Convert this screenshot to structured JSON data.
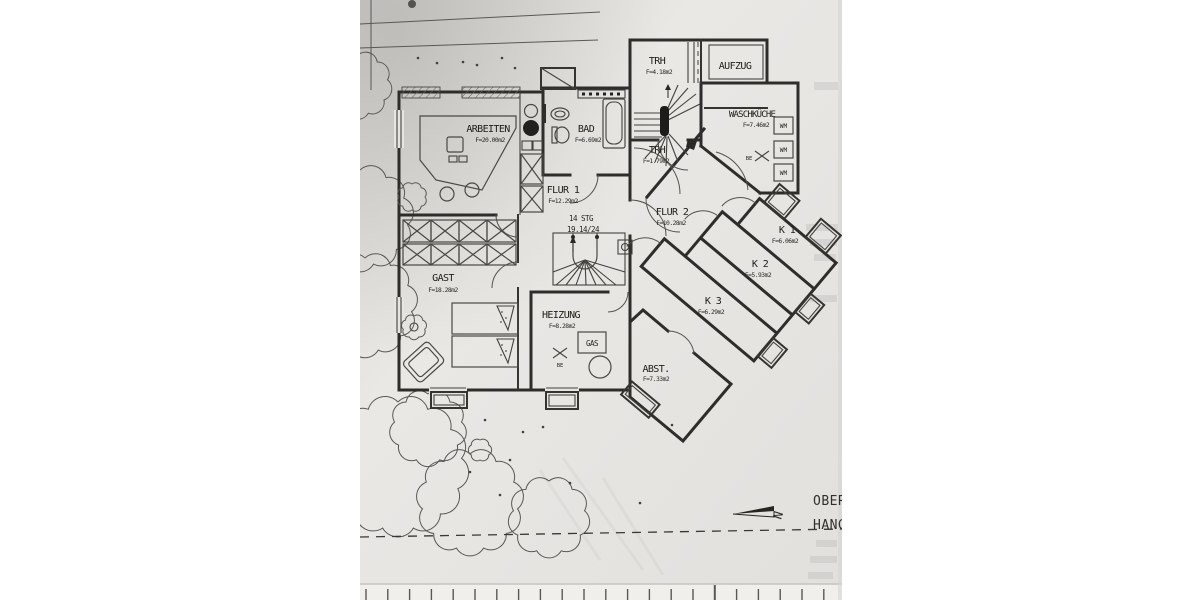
{
  "plan": {
    "rooms": [
      {
        "id": "arbeiten",
        "name": "ARBEITEN",
        "area": "F=20.00m2"
      },
      {
        "id": "bad",
        "name": "BAD",
        "area": "F=6.69m2"
      },
      {
        "id": "trh-top",
        "name": "TRH",
        "area": "F=4.18m2"
      },
      {
        "id": "aufzug",
        "name": "AUFZUG",
        "area": ""
      },
      {
        "id": "waschkueche",
        "name": "WASCHKÜCHE",
        "area": "F=7.46m2"
      },
      {
        "id": "trh-lower",
        "name": "TRH",
        "area": "F=1.79m2"
      },
      {
        "id": "flur1",
        "name": "FLUR 1",
        "area": "F=12.29m2"
      },
      {
        "id": "flur2",
        "name": "FLUR 2",
        "area": "F=10.28m2"
      },
      {
        "id": "k1",
        "name": "K 1",
        "area": "F=6.06m2"
      },
      {
        "id": "k2",
        "name": "K 2",
        "area": "F=5.93m2"
      },
      {
        "id": "k3",
        "name": "K 3",
        "area": "F=6.29m2"
      },
      {
        "id": "gast",
        "name": "GAST",
        "area": "F=18.28m2"
      },
      {
        "id": "heizung",
        "name": "HEIZUNG",
        "area": "F=8.28m2"
      },
      {
        "id": "abst",
        "name": "ABST.",
        "area": "F=7.33m2"
      }
    ],
    "stair_note": {
      "steps": "14 STG",
      "dims": "19.14/24"
    },
    "labels": {
      "gas": "GAS",
      "wm": "WM",
      "be": "BE"
    },
    "compass": {
      "north": "N"
    },
    "margin": {
      "line1": "OBER",
      "line2": "HANG"
    }
  }
}
